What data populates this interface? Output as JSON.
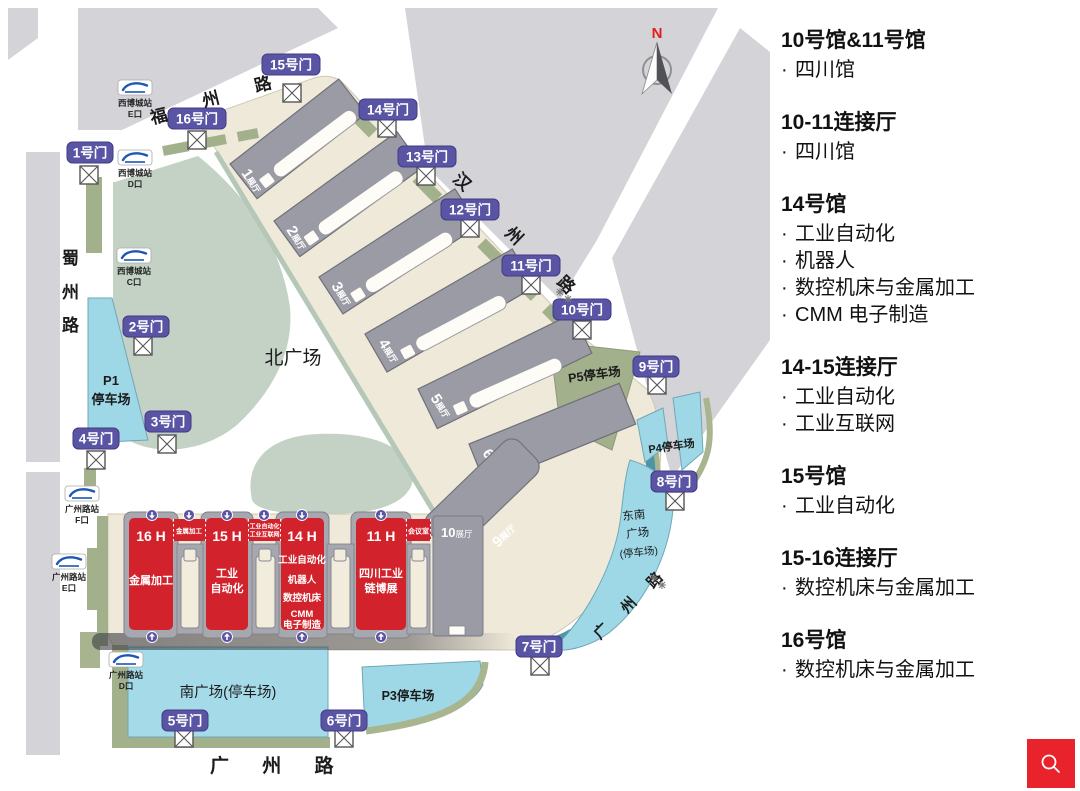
{
  "legend": {
    "bullet": "·",
    "sections": [
      {
        "title": "10号馆&11号馆",
        "items": [
          "四川馆"
        ]
      },
      {
        "title": "10-11连接厅",
        "items": [
          "四川馆"
        ]
      },
      {
        "title": "14号馆",
        "items": [
          "工业自动化",
          "机器人",
          "数控机床与金属加工",
          "CMM 电子制造"
        ]
      },
      {
        "title": "14-15连接厅",
        "items": [
          "工业自动化",
          "工业互联网"
        ]
      },
      {
        "title": "15号馆",
        "items": [
          "工业自动化"
        ]
      },
      {
        "title": "15-16连接厅",
        "items": [
          "数控机床与金属加工"
        ]
      },
      {
        "title": "16号馆",
        "items": [
          "数控机床与金属加工"
        ]
      }
    ]
  },
  "map": {
    "compass_label": "N",
    "roads": {
      "fuzhou": [
        "福",
        "州",
        "路"
      ],
      "hanzhou": [
        "汉",
        "州",
        "路"
      ],
      "shuzhou": [
        "蜀",
        "州",
        "路"
      ],
      "guangzhou_south": "广  州  路",
      "guangzhou_east": [
        "广",
        "州",
        "路"
      ]
    },
    "plazas": {
      "north": "北广场",
      "south": "南广场(停车场)",
      "southeast_lines": [
        "东南",
        "广场",
        "(停车场)"
      ]
    },
    "parking": {
      "p1_lines": [
        "P1",
        "停车场"
      ],
      "p3": "P3停车场",
      "p4": "P4停车场",
      "p5": "P5停车场"
    },
    "gates": [
      "1号门",
      "2号门",
      "3号门",
      "4号门",
      "5号门",
      "6号门",
      "7号门",
      "8号门",
      "9号门",
      "10号门",
      "11号门",
      "12号门",
      "13号门",
      "14号门",
      "15号门",
      "16号门"
    ],
    "metro_stations": [
      {
        "station": "西博城站",
        "exit": "E口"
      },
      {
        "station": "西博城站",
        "exit": "D口"
      },
      {
        "station": "西博城站",
        "exit": "C口"
      },
      {
        "station": "广州路站",
        "exit": "F口"
      },
      {
        "station": "广州路站",
        "exit": "E口"
      },
      {
        "station": "广州路站",
        "exit": "D口"
      }
    ],
    "halls_north": [
      {
        "num": "1",
        "suffix": "展厅"
      },
      {
        "num": "2",
        "suffix": "展厅"
      },
      {
        "num": "3",
        "suffix": "展厅"
      },
      {
        "num": "4",
        "suffix": "展厅"
      },
      {
        "num": "5",
        "suffix": "展厅"
      },
      {
        "num": "6",
        "suffix": "展厅"
      }
    ],
    "hall9": {
      "num": "9",
      "suffix": "展厅"
    },
    "hall10": {
      "num": "10",
      "suffix": "展厅"
    },
    "red_halls": [
      {
        "title": "16 H",
        "lines": [
          "金属加工"
        ]
      },
      {
        "title": "15 H",
        "lines": [
          "工业",
          "自动化"
        ]
      },
      {
        "title": "14 H",
        "lines": [
          "工业自动化",
          "机器人",
          "数控机床",
          "CMM",
          "电子制造"
        ]
      },
      {
        "title": "11 H",
        "lines": [
          "四川工业",
          "链博展"
        ]
      }
    ],
    "connectors": [
      {
        "lines": [
          "金属加工"
        ]
      },
      {
        "lines": [
          "工业自动化",
          "工业互联网"
        ]
      },
      {
        "lines": [
          "会议室"
        ]
      }
    ],
    "colors": {
      "red_hall": "#d2232c",
      "gate_purple": "#5a54a4",
      "parking_cyan": "#9ed8e6",
      "olive": "#a3b08c",
      "sage": "#c4d2c5",
      "cream": "#efe9d9",
      "hall_gray": "#9b9ba5",
      "teal_rim": "#4d95a5",
      "search_red": "#e8232c"
    }
  },
  "search_button": {
    "icon": "search"
  }
}
